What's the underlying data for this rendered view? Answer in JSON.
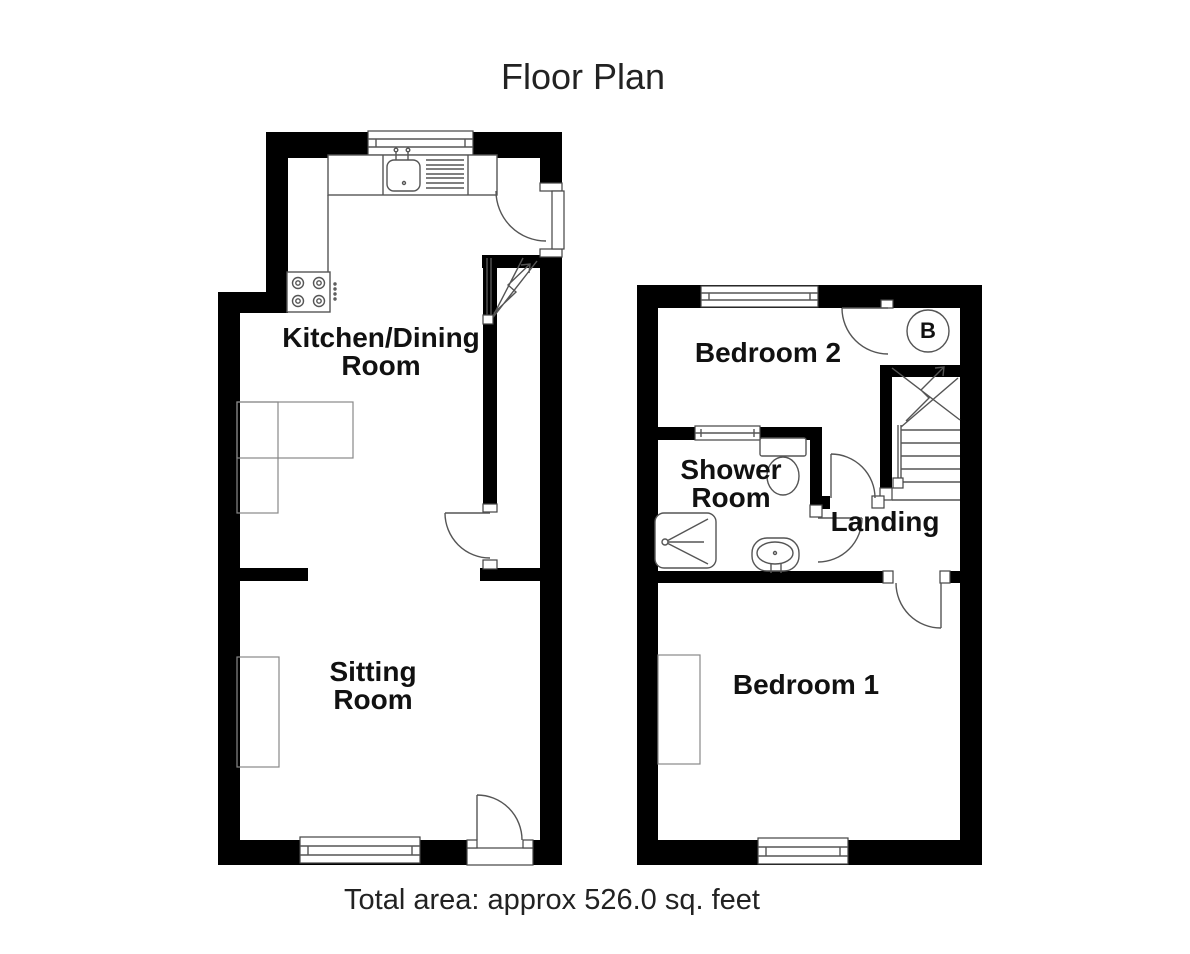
{
  "title": "Floor Plan",
  "footer": {
    "total_area": "Total area: approx 526.0 sq. feet"
  },
  "rooms": {
    "kitchen": {
      "line1": "Kitchen/Dining",
      "line2": "Room"
    },
    "sitting": {
      "line1": "Sitting",
      "line2": "Room"
    },
    "bedroom2": {
      "label": "Bedroom 2"
    },
    "shower": {
      "line1": "Shower",
      "line2": "Room"
    },
    "landing": {
      "label": "Landing"
    },
    "bedroom1": {
      "label": "Bedroom 1"
    },
    "boiler": {
      "label": "B"
    }
  },
  "colors": {
    "wall": "#000000",
    "line": "#555555",
    "furniture": "#888888",
    "text": "#111111",
    "background": "#ffffff"
  }
}
